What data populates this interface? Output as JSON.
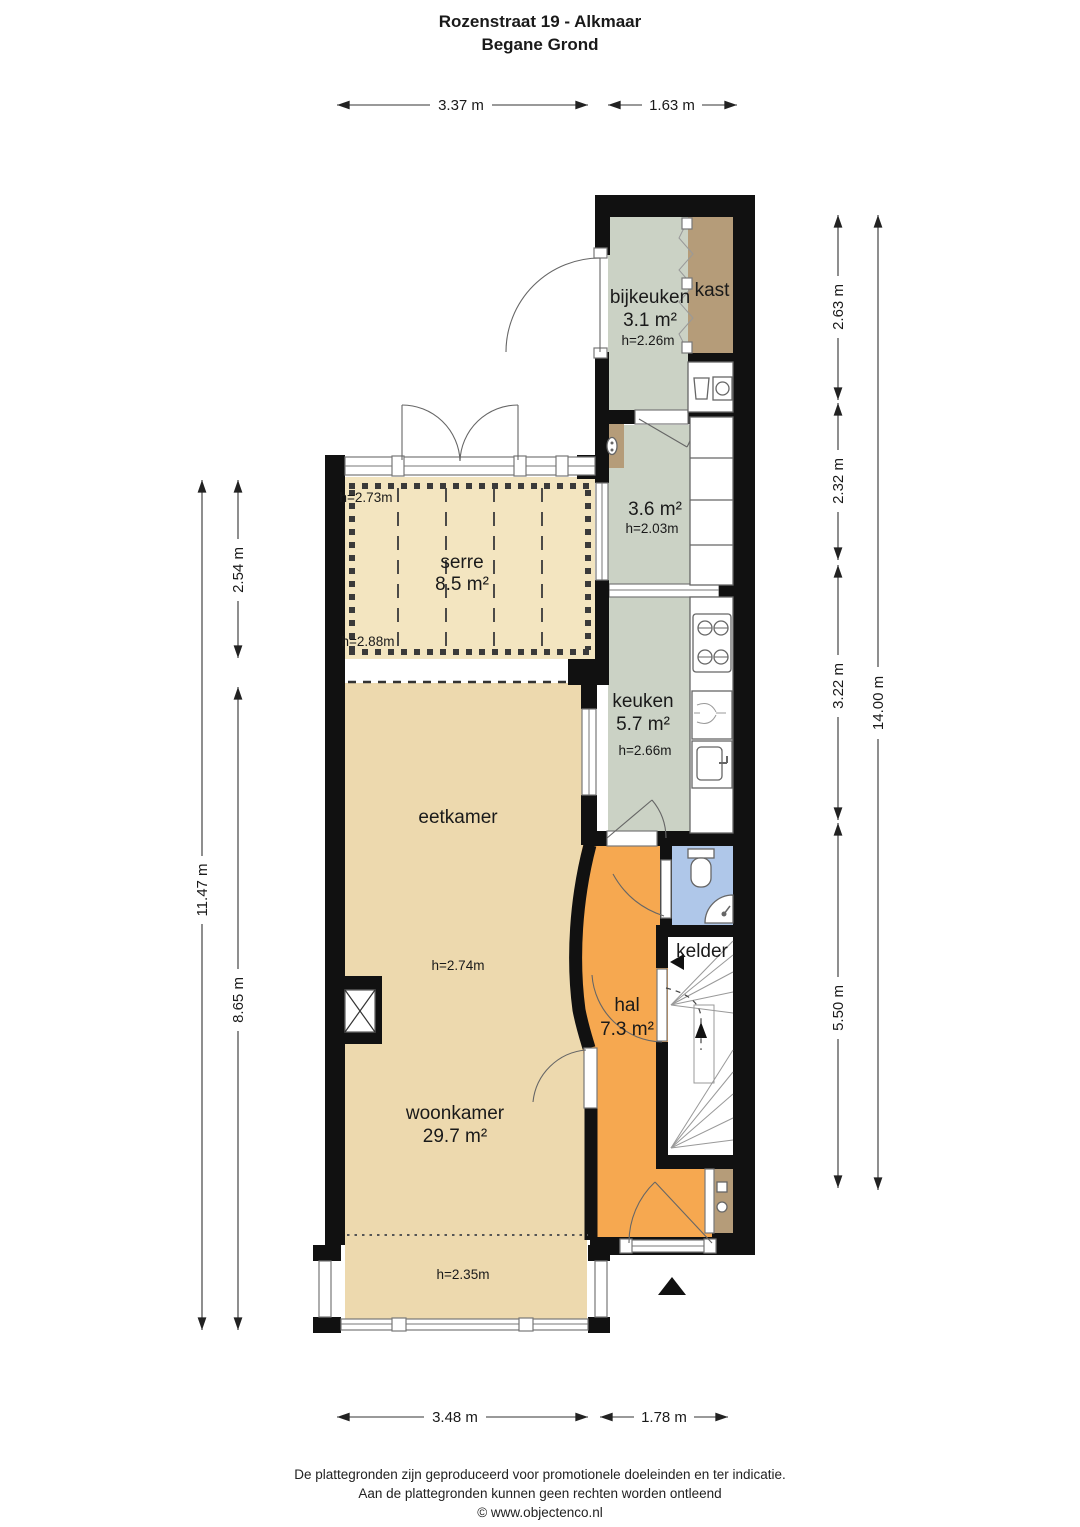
{
  "title": {
    "line1": "Rozenstraat 19 - Alkmaar",
    "line2": "Begane Grond"
  },
  "rooms": {
    "bijkeuken": {
      "name": "bijkeuken",
      "area": "3.1 m²",
      "ceiling": "h=2.26m"
    },
    "kast": {
      "name": "kast"
    },
    "hallway": {
      "area": "3.6 m²",
      "ceiling": "h=2.03m"
    },
    "serre": {
      "name": "serre",
      "area": "8.5 m²",
      "ceiling_front": "h=2.73m",
      "ceiling_back": "h=2.88m"
    },
    "keuken": {
      "name": "keuken",
      "area": "5.7 m²",
      "ceiling": "h=2.66m"
    },
    "eetkamer": {
      "name": "eetkamer",
      "ceiling": "h=2.74m"
    },
    "woonkamer": {
      "name": "woonkamer",
      "area": "29.7 m²",
      "ceiling_bay": "h=2.35m"
    },
    "hal": {
      "name": "hal",
      "area": "7.3 m²"
    },
    "kelder": {
      "name": "kelder"
    }
  },
  "dimensions": {
    "top_serre": "3.37 m",
    "top_right": "1.63 m",
    "bottom_left": "3.48 m",
    "bottom_right": "1.78 m",
    "left_total": "11.47 m",
    "left_serre": "2.54 m",
    "left_main": "8.65 m",
    "right_bijkeuken": "2.63 m",
    "right_hallway": "2.32 m",
    "right_keuken": "3.22 m",
    "right_hal": "5.50 m",
    "right_total": "14.00 m"
  },
  "footer": {
    "line1": "De plattegronden zijn geproduceerd voor promotionele doeleinden en ter indicatie.",
    "line2": "Aan de plattegronden kunnen geen rechten worden ontleend",
    "line3": "© www.objectenco.nl"
  },
  "colors": {
    "wall": "#111111",
    "living_floor": "#EDD9AE",
    "serre_floor": "#F3E5C0",
    "service_floor": "#CBD2C5",
    "closet_floor": "#B59C79",
    "hall_floor": "#F6A850",
    "toilet_floor": "#AFC7E9"
  }
}
